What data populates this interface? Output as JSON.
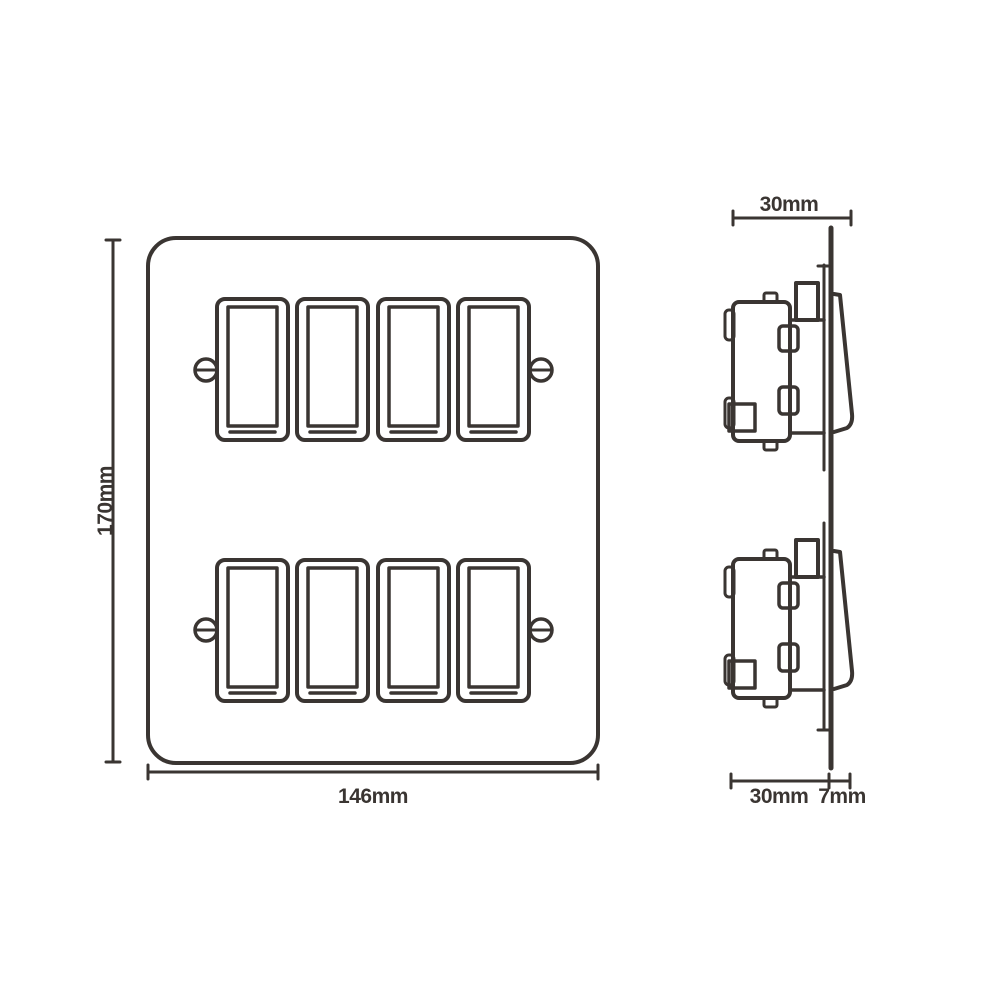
{
  "colors": {
    "line": "#3a3532",
    "background": "#ffffff"
  },
  "front_view": {
    "width_label": "146mm",
    "height_label": "170mm"
  },
  "side_view": {
    "total_depth_label": "30mm",
    "mechanism_depth_label": "30mm",
    "rocker_projection_label": "7mm"
  }
}
